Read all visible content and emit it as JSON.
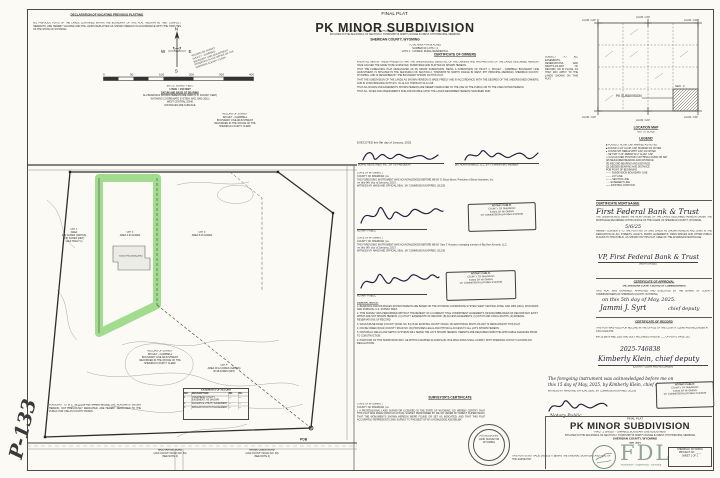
{
  "sheet": {
    "ref": "P-133"
  },
  "titleblock": {
    "eyebrow": "FINAL PLAT",
    "title": "PK MINOR SUBDIVISION",
    "sub1": "A SUBDIVISION OF TRACT 1, SHULEY - CAMPBELL BOUNDARY LINE ADJUSTMENT",
    "sub2": "SITUATED IN THE SE1/4SW1/4 OF SECTION 2, TOWNSHIP 56 NORTH, RANGE 84 WEST, 6TH PRINCIPAL MERIDIAN",
    "county": "SHERIDAN COUNTY, WYOMING",
    "stat1": "TOTAL AREA = 64.58 ACRES",
    "stat2": "NUMBER OF LOTS = 4",
    "stat3": "LOTS 1 - 4 ZONED: RURAL RESIDENTIAL"
  },
  "declaration": {
    "title": "DECLARATION OF VACATING PREVIOUS PLATTING",
    "body": "ALL PREVIOUS PLATS OF THE LANDS CONTAINED WITHIN THE BOUNDARY OF THIS PLAT, INSOFAR AS THEY CONFLICT HEREWITH, ARE HEREBY VACATED AND THE LANDS REPLATTED AS SHOWN HEREON IN ACCORDANCE WITH THE STATUTES OF THE STATE OF WYOMING."
  },
  "compass": {
    "n": "N",
    "e": "E",
    "s": "S",
    "w": "W"
  },
  "scalebar": {
    "t0": "0",
    "t1": "50",
    "t2": "100",
    "t3": "200",
    "t4": "300",
    "t5": "400",
    "unit": "(IN U.S. SURVEY FEET)",
    "ratio": "1 INCH = 100 FEET"
  },
  "datum": {
    "title": "DATUM AND BASIS OF BEARING",
    "l1": "ALL BEARINGS SHOWN HEREON ARE GRID (U.S. SURVEY FEET)",
    "l2": "WYOMING COORDINATE SYSTEM, NAD 1983 (2011)",
    "l3": "WEST CENTRAL ZONE",
    "l4": "DISTANCES ARE SURFACE"
  },
  "surveyref": {
    "l1": "RECORD OF SURVEY",
    "l2": "SHULEY - CAMPBELL",
    "l3": "BOUNDARY LINE ADJUSTMENT",
    "l4": "RECORDED IN THE OFFICE OF THE",
    "l5": "SHERIDAN COUNTY CLERK"
  },
  "map": {
    "lot1_name": "LOT 1",
    "lot1_l1": "AREA",
    "lot1_l2": "2.47 ACRES (GROSS)",
    "lot1_l3": "2.07 ACRES (NET)",
    "lot1_l4": "(AKA TRACT 1)",
    "lot2_name": "LOT 2",
    "lot2_area": "AREA 4.93 ACRES",
    "lot3_name": "LOT 3",
    "lot3_area": "AREA 5.06 ACRES",
    "lot4_name": "LOT 4",
    "lot4_l1": "AREA 49.12 ACRES (GROSS)",
    "lot4_l2": "46.38 ACRES (NET)",
    "building": "EXISTING BUILDING",
    "pob": "POB",
    "note": "PURSUANT TO W.S. 34-12-104 ALL LANDS WITHIN THE ROADWAYS SHOWN HEREON, NOT PREVIOUSLY DEDICATED, ARE HEREBY DEDICATED TO THE PUBLIC FOR USE AS COUNTY ROADS.",
    "road_left_name": "WOLF/KRUSE ROAD",
    "road_left_aka": "(AKA COUNTY ROAD NO. 84)",
    "road_left_note": "(SEE NOTE 3)",
    "road_ctr_name": "KRUSE CREEK ROAD",
    "road_ctr_aka": "(AKA COUNTY ROAD NO. 84)",
    "road_ctr_note": "(SEE NOTE 4)",
    "easements": {
      "title": "EASEMENTS OF RECORD",
      "h0": "NO.",
      "h1": "DESCRIPTION",
      "h2": "BK.",
      "h3": "PG.",
      "rows": [
        [
          "1",
          "OVERHEAD UTILITY EASEMENT, AS SHOWN",
          "—",
          "—"
        ],
        [
          "2",
          "ACCESS & UTILITY EASEMENT",
          "—",
          "—"
        ],
        [
          "3",
          "IRRIGATION DITCH EASEMENT",
          "—",
          "—"
        ]
      ]
    }
  },
  "owners": {
    "heading": "CERTIFICATE OF OWNERS",
    "p1": "KNOW ALL MEN BY THESE PRESENTS THAT THE UNDERSIGNED, BEING ALL OF THE OWNERS AND PROPRIETORS OF THE LANDS DESCRIBED HEREON, HAVE CAUSED THE SAME TO BE SURVEYED, SUBDIVIDED AND PLATTED AS SHOWN HEREON.",
    "p2": "THAT THE FOREGOING PLAT DESIGNATED AS PK MINOR SUBDIVISION, BEING A SUBDIVISION OF TRACT 1, SHULEY - CAMPBELL BOUNDARY LINE ADJUSTMENT, IS SITUATED IN THE SE1/4SW1/4 OF SECTION 2, TOWNSHIP 56 NORTH, RANGE 84 WEST, 6TH PRINCIPAL MERIDIAN, SHERIDAN COUNTY, WYOMING, AND IS DESCRIBED BY THE BOUNDARY SHOWN ON THIS PLAT.",
    "p3": "THAT THE SUBDIVISION OF THE LANDS AS SHOWN HEREON IS MADE FREELY AND IN ACCORDANCE WITH THE DESIRES OF THE UNDERSIGNED OWNERS, AND IN CONFORMANCE WITH W.S. 34-12-101 THROUGH 34-12-115.",
    "p4": "THAT ALL ROADS AND EASEMENTS SHOWN HEREON ARE HEREBY DEDICATED TO THE USE OF THE PUBLIC OR TO THE USES NOTED HEREON.",
    "p5": "THAT ALL TAXES AND ASSESSMENTS DUE AND PAYABLE UPON THE LANDS DESCRIBED HEREON HAVE BEEN PAID.",
    "executed": "EXECUTED this 9th day of January, 2025.",
    "sig1_caption": "BURNS INDUSTRIES, INC., BY ITS PRESIDENT",
    "sig2_caption": "BIG HORN KENNELS, LLC, BY ITS MANAGING MEMBER"
  },
  "notary1": {
    "state": "STATE OF WYOMING )",
    "county": "COUNTY OF SHERIDAN ) ss.",
    "ack": "THE FOREGOING INSTRUMENT WAS ACKNOWLEDGED BEFORE ME BY D. Bruce Burns, President of Burns Industries, Inc.",
    "date": "on this 9th day of January, 2025.",
    "witness": "WITNESS MY HAND AND OFFICIAL SEAL.  MY COMMISSION EXPIRES: 3/12/30",
    "caption": "NOTARY PUBLIC"
  },
  "notary2": {
    "state": "STATE OF WYOMING )",
    "county": "COUNTY OF SHERIDAN ) ss.",
    "ack": "THE FOREGOING INSTRUMENT WAS ACKNOWLEDGED BEFORE ME BY Gary T. Houston, managing member of Big Horn Kennels, LLC,",
    "date": "on this 9th day of January, 2025.",
    "witness": "WITNESS MY HAND AND OFFICIAL SEAL.  MY COMMISSION EXPIRES: 3/12/30",
    "caption": "NOTARY PUBLIC"
  },
  "stamp": {
    "l1": "NOTARY PUBLIC",
    "l2": "COUNTY OF SHERIDAN",
    "l3": "STATE OF WYOMING",
    "l4": "MY COMMISSION EXPIRES 3/12/2030"
  },
  "notes": {
    "heading": "GENERAL NOTES:",
    "i1": "1. BEARINGS AND DISTANCES SHOWN HEREON ARE BASED ON THE WYOMING COORDINATE SYSTEM, WEST CENTRAL ZONE, NAD 1983 (2011). DISTANCES ARE SURFACE, U.S. SURVEY FEET.",
    "i2": "2. THIS SURVEY WAS PERFORMED WITHOUT THE BENEFIT OF A CURRENT TITLE COMMITMENT. EASEMENTS OR ENCUMBRANCES OF RECORD MAY EXIST WHICH ARE NOT SHOWN HEREON: (A) UTILITY EASEMENTS OF RECORD; (B) ACCESS EASEMENTS; (C) DITCH AND CANAL RIGHTS; (D) MINERAL RESERVATIONS OF RECORD.",
    "i3": "3. WOLF/KRUSE ROAD (COUNTY ROAD NO. 84) IS AN EXISTING COUNTY ROAD. NO ADDITIONAL RIGHT-OF-WAY IS DEDICATED BY THIS PLAT.",
    "i4": "4. KRUSE CREEK ROAD (COUNTY ROAD NO. 84) PROVIDES LEGAL AND PHYSICAL ACCESS TO ALL LOTS SHOWN HEREON.",
    "i5": "5. INDIVIDUAL WELLS AND SEPTIC SYSTEMS WILL SERVE THE LOTS SHOWN HEREON. PERMITS ARE REQUIRED FROM THE APPLICABLE AGENCIES PRIOR TO CONSTRUCTION.",
    "i6": "6. PORTIONS OF THIS SUBDIVISION MAY LIE WITHIN A MAPPED FLOODPLAIN. BUILDING SITES SHALL COMPLY WITH SHERIDAN COUNTY FLOODPLAIN REGULATIONS."
  },
  "surveyor": {
    "heading": "SURVEYOR'S CERTIFICATE",
    "state": "STATE OF WYOMING )",
    "county": "COUNTY OF SHERIDAN ) ss.",
    "body": "I, A PROFESSIONAL LAND SURVEYOR LICENSED IN THE STATE OF WYOMING, DO HEREBY CERTIFY THAT THIS PLAT WAS MADE FROM AN ACTUAL SURVEY PERFORMED BY ME OR UNDER MY DIRECT SUPERVISION; THAT THE MONUMENTS SHOWN HEREON WERE FOUND OR SET AS INDICATED; AND THAT THIS PLAT ACCURATELY REPRESENTS SAID SURVEY TO THE BEST OF MY KNOWLEDGE AND BELIEF.",
    "valid": "THIS PLAT IS NOT VALID UNLESS IT BEARS THE ORIGINAL SIGNATURE AND SEAL OF THE SURVEYOR.",
    "seal1": "PROFESSIONAL",
    "seal2": "LAND SURVEYOR",
    "seal3": "WYOMING"
  },
  "sidecol": {
    "body": "SUBJECT TO ALL EASEMENTS, RESERVATIONS AND RIGHTS-OF-WAY OF RECORD, OR IN PLACE, AS THEY MAY APPLY TO THE LANDS SHOWN ON THIS PLAT."
  },
  "locmap": {
    "title": "LOCATION MAP",
    "scale": "NOT TO SCALE",
    "target": "PK SUBDIVISION",
    "mon": "ALUM. CAP",
    "sec": "SEC. 2"
  },
  "legend": {
    "heading": "LEGEND",
    "items": [
      {
        "sym": "■",
        "text": "FOUND 2\" ALUM. CAP, MARKED AS NOTED"
      },
      {
        "sym": "■",
        "text": "FOUND 3-1/4\" ALUM. CAP, MARKED AS NOTED"
      },
      {
        "sym": "●",
        "text": "FOUND 5/8\" REBAR WITH CAP, AS NOTED"
      },
      {
        "sym": "○",
        "text": "SET 5/8\" X 24\" REBAR W/ 2\" ALUM. CAP"
      },
      {
        "sym": "◇",
        "text": "CALCULATED POSITION, NOTHING FOUND OR SET"
      },
      {
        "sym": "(M)",
        "text": "MEASURED BEARING AND DISTANCE"
      },
      {
        "sym": "(R)",
        "text": "RECORD BEARING AND DISTANCE"
      },
      {
        "sym": "(D)",
        "text": "DEEDED BEARING AND DISTANCE"
      },
      {
        "sym": "POB",
        "text": "POINT OF BEGINNING"
      },
      {
        "sym": "───",
        "text": "SUBDIVISION BOUNDARY LINE"
      },
      {
        "sym": "– – –",
        "text": "LOT LINE"
      },
      {
        "sym": "—·—",
        "text": "SECTION LINE"
      },
      {
        "sym": "·····",
        "text": "EASEMENT LINE"
      },
      {
        "sym": "~~~",
        "text": "EXISTING CONTOUR"
      }
    ]
  },
  "mortgagee": {
    "heading": "CERTIFICATE MORTGAGEE",
    "bank": "First Federal Bank & Trust",
    "p1": "THE UNDERSIGNED, BEING THE MORTGAGEE OF THE LANDS DESCRIBED HEREON UNDER THE MORTGAGE RECORDED IN THE OFFICE OF THE CLERK OF SHERIDAN COUNTY, WYOMING,",
    "hand": "5/6/25",
    "p2": "HEREBY CONSENTS TO THE PLATTING OF SAID LANDS AS SHOWN HEREON AND JOINS IN THE DEDICATION OF ALL STREETS, ALLEYS, PARKS, EASEMENTS, OPEN SPACES AND OTHER PUBLIC PLACES TO THE PUBLIC, AS SHOWN ON THIS PLAT, FREE OF THE AFORESAID MORTGAGE.",
    "sig": "VP, First Federal Bank & Trust",
    "caption": "(MORTGAGEE)"
  },
  "approval": {
    "h1": "CERTIFICATE OF APPROVAL",
    "h2": "THE SHERIDAN COUNTY BOARD OF COMMISSIONERS",
    "body": "THIS PLAT WAS EXAMINED, APPROVED AND EXECUTED BY THE BOARD OF COUNTY COMMISSIONERS OF SHERIDAN COUNTY, WYOMING,",
    "date": "on this 5th day of May, 2025.",
    "sig": "Jammi J. Syrt",
    "sigcap": "chief deputy"
  },
  "record": {
    "heading": "CERTIFICATE OF RECORD",
    "l1": "THIS PLAT WAS FILED FOR RECORD IN THE OFFICE OF THE COUNTY CLERK AND RECORDER AT 3:49 o'clock P.M.",
    "l2": "this 15 day of May, 2025, AND DULY RECORDED IN BOOK ___ OF PLATS, PAGE 133.",
    "reception": "2025-746838",
    "sig": "Kimberly Klein, chief deputy",
    "sigcap": "(COUNTY CLERK AND RECORDER)",
    "ack": "The foregoing instrument was acknowledged before me on this 15 day of May, 2025, by Kimberly Klein, chief deputy.",
    "witness": "WITNESS MY HAND AND OFFICIAL SEAL.  MY COMMISSION EXPIRES: 3/12/30",
    "notary": "Notary Public"
  },
  "footer": {
    "eyebrow": "FINAL PLAT",
    "title": "PK MINOR SUBDIVISION",
    "sub1": "TRACT 1, SHULEY - CAMPBELL BOUNDARY LINE ADJUSTMENT",
    "sub2": "SITUATED IN THE SE1/4SW1/4 OF SECTION 2, TOWNSHIP 56 NORTH, RANGE 84 WEST, 6TH PRINCIPAL MERIDIAN",
    "county": "SHERIDAN COUNTY, WYOMING",
    "date": "MAY 2024"
  },
  "fdl": {
    "name": "FDL",
    "tagline": "Architecture · Engineering · Surveying",
    "b1": "SHERIDAN, WYOMING",
    "b2": "PROJECT NO. ____",
    "b3": "SHEET 1 OF 1"
  },
  "colors": {
    "highlight": "#58c23a",
    "paper": "#fbfaf5",
    "ink": "#2b2b2b"
  }
}
